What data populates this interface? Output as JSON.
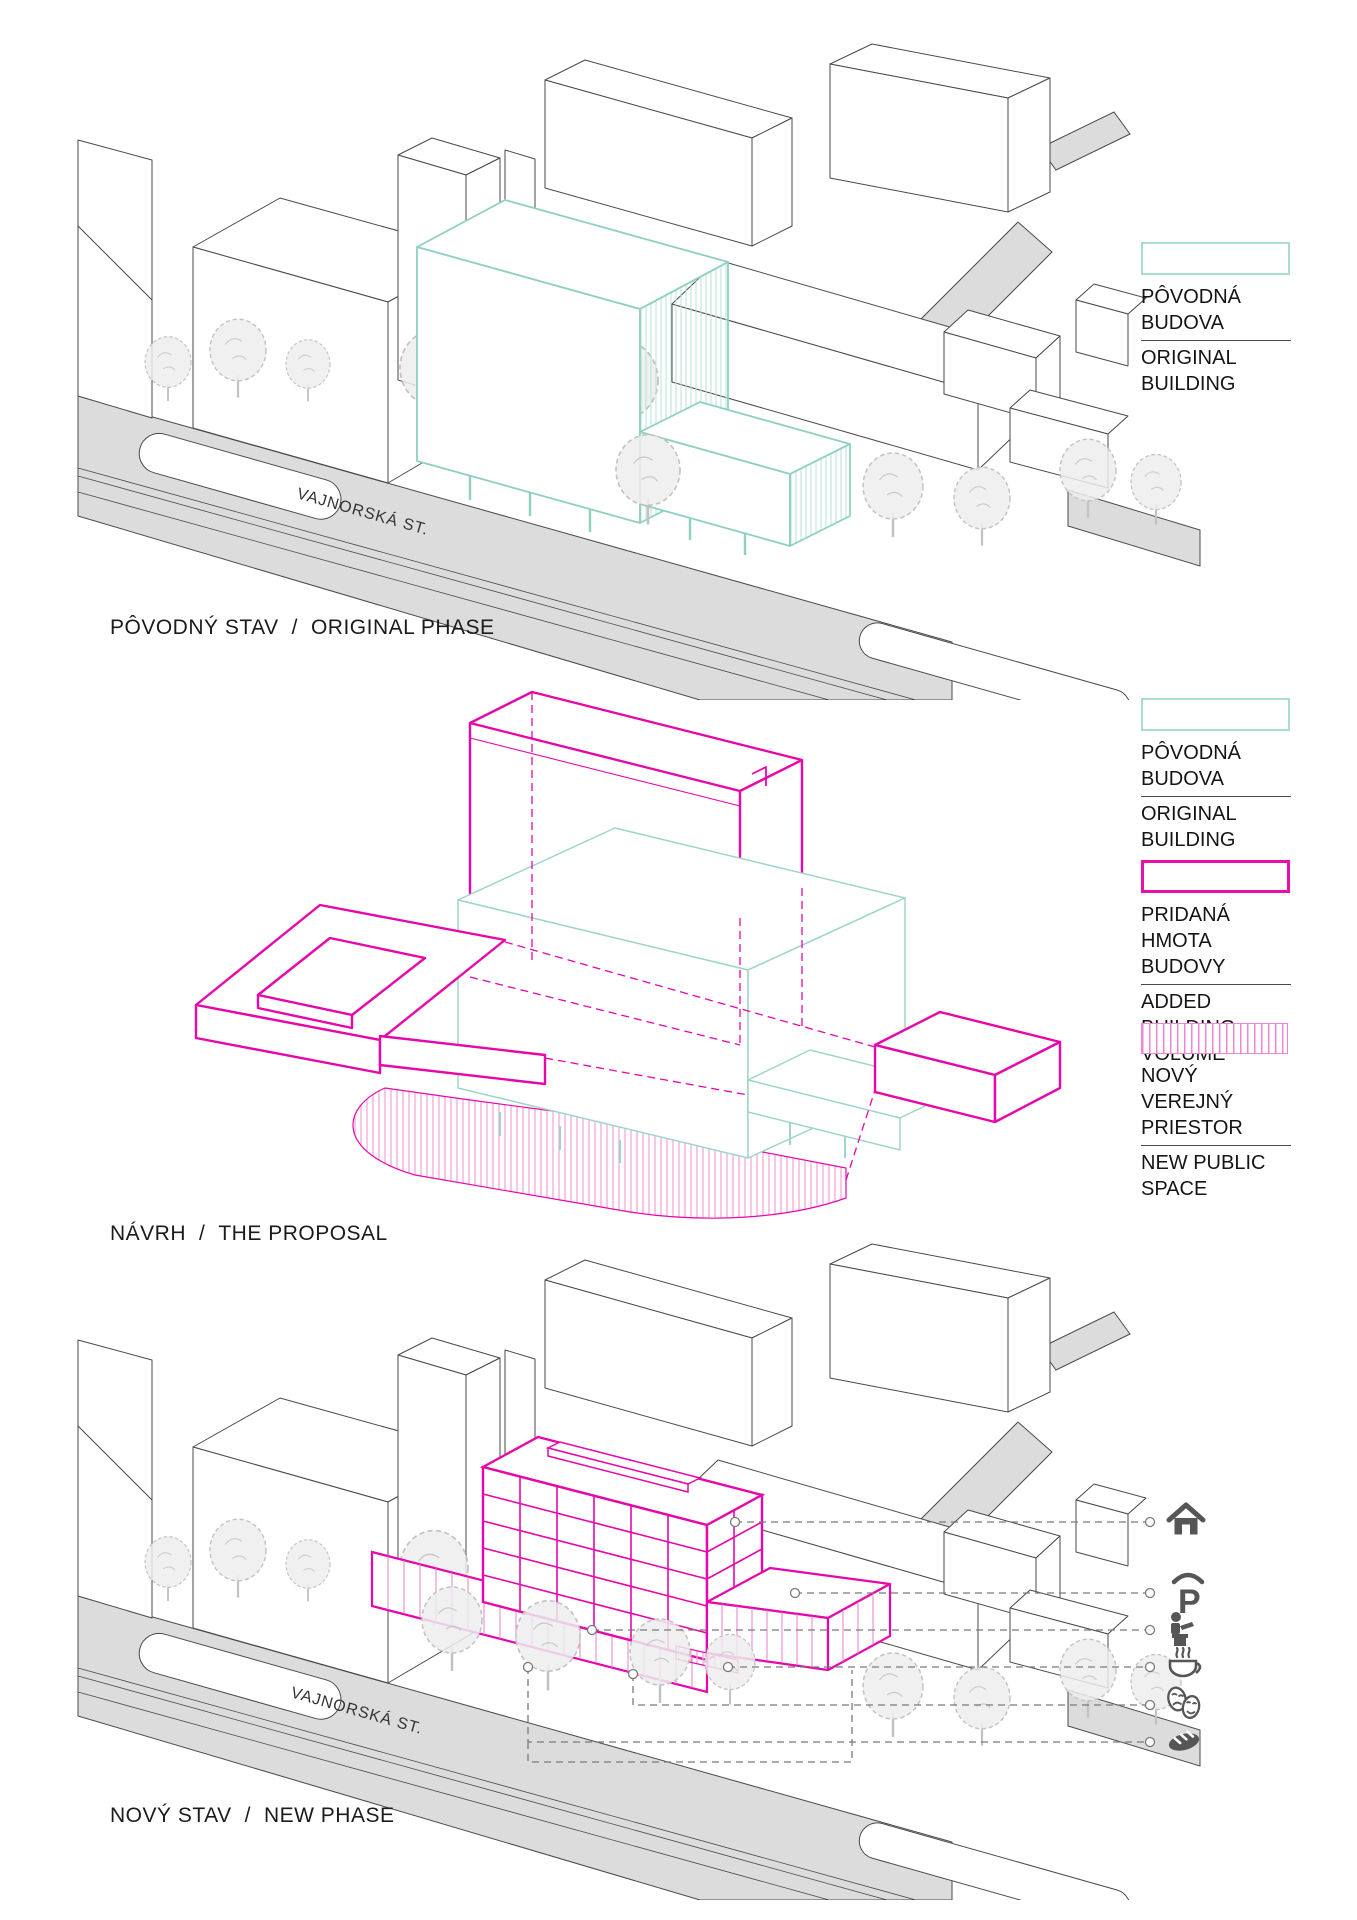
{
  "document": {
    "background": "#ffffff",
    "kind": "architectural phase diagram sheet"
  },
  "colors": {
    "original_teal": "#8ed0c1",
    "added_magenta": "#e607ab",
    "public_space_pink": "#ee86d4",
    "road_gray": "#dcdcdc",
    "context_line": "#4a4a4a",
    "tree_gray": "#c2c2c2",
    "icon_gray": "#565656",
    "leader_gray": "#7a7a7a",
    "text": "#1b1b1b"
  },
  "sections": {
    "original": {
      "title_sk": "PÔVODNÝ STAV",
      "sep": "/",
      "title_en": "ORIGINAL PHASE",
      "street_label": "VAJNORSKÁ ST."
    },
    "proposal": {
      "title_sk": "NÁVRH",
      "sep": "/",
      "title_en": "THE PROPOSAL"
    },
    "new": {
      "title_sk": "NOVÝ STAV",
      "sep": "/",
      "title_en": "NEW PHASE",
      "street_label": "VAJNORSKÁ ST."
    }
  },
  "legends": {
    "original": {
      "sk1": "PÔVODNÁ",
      "sk2": "BUDOVA",
      "en1": "ORIGINAL",
      "en2": "BUILDING",
      "swatch": "teal-outline"
    },
    "added": {
      "sk1": "PRIDANÁ HMOTA",
      "sk2": "BUDOVY",
      "en1": "ADDED BUILDING",
      "en2": "VOLUME",
      "swatch": "magenta-outline"
    },
    "public_space": {
      "sk1": "NOVÝ VEREJNÝ",
      "sk2": "PRIESTOR",
      "en1": "NEW PUBLIC",
      "en2": "SPACE",
      "swatch": "pink-vertical-hatch"
    }
  },
  "program_icons": [
    {
      "name": "home"
    },
    {
      "name": "parking",
      "glyph": "P"
    },
    {
      "name": "workspace"
    },
    {
      "name": "cafe"
    },
    {
      "name": "theater-masks"
    },
    {
      "name": "bakery"
    }
  ]
}
